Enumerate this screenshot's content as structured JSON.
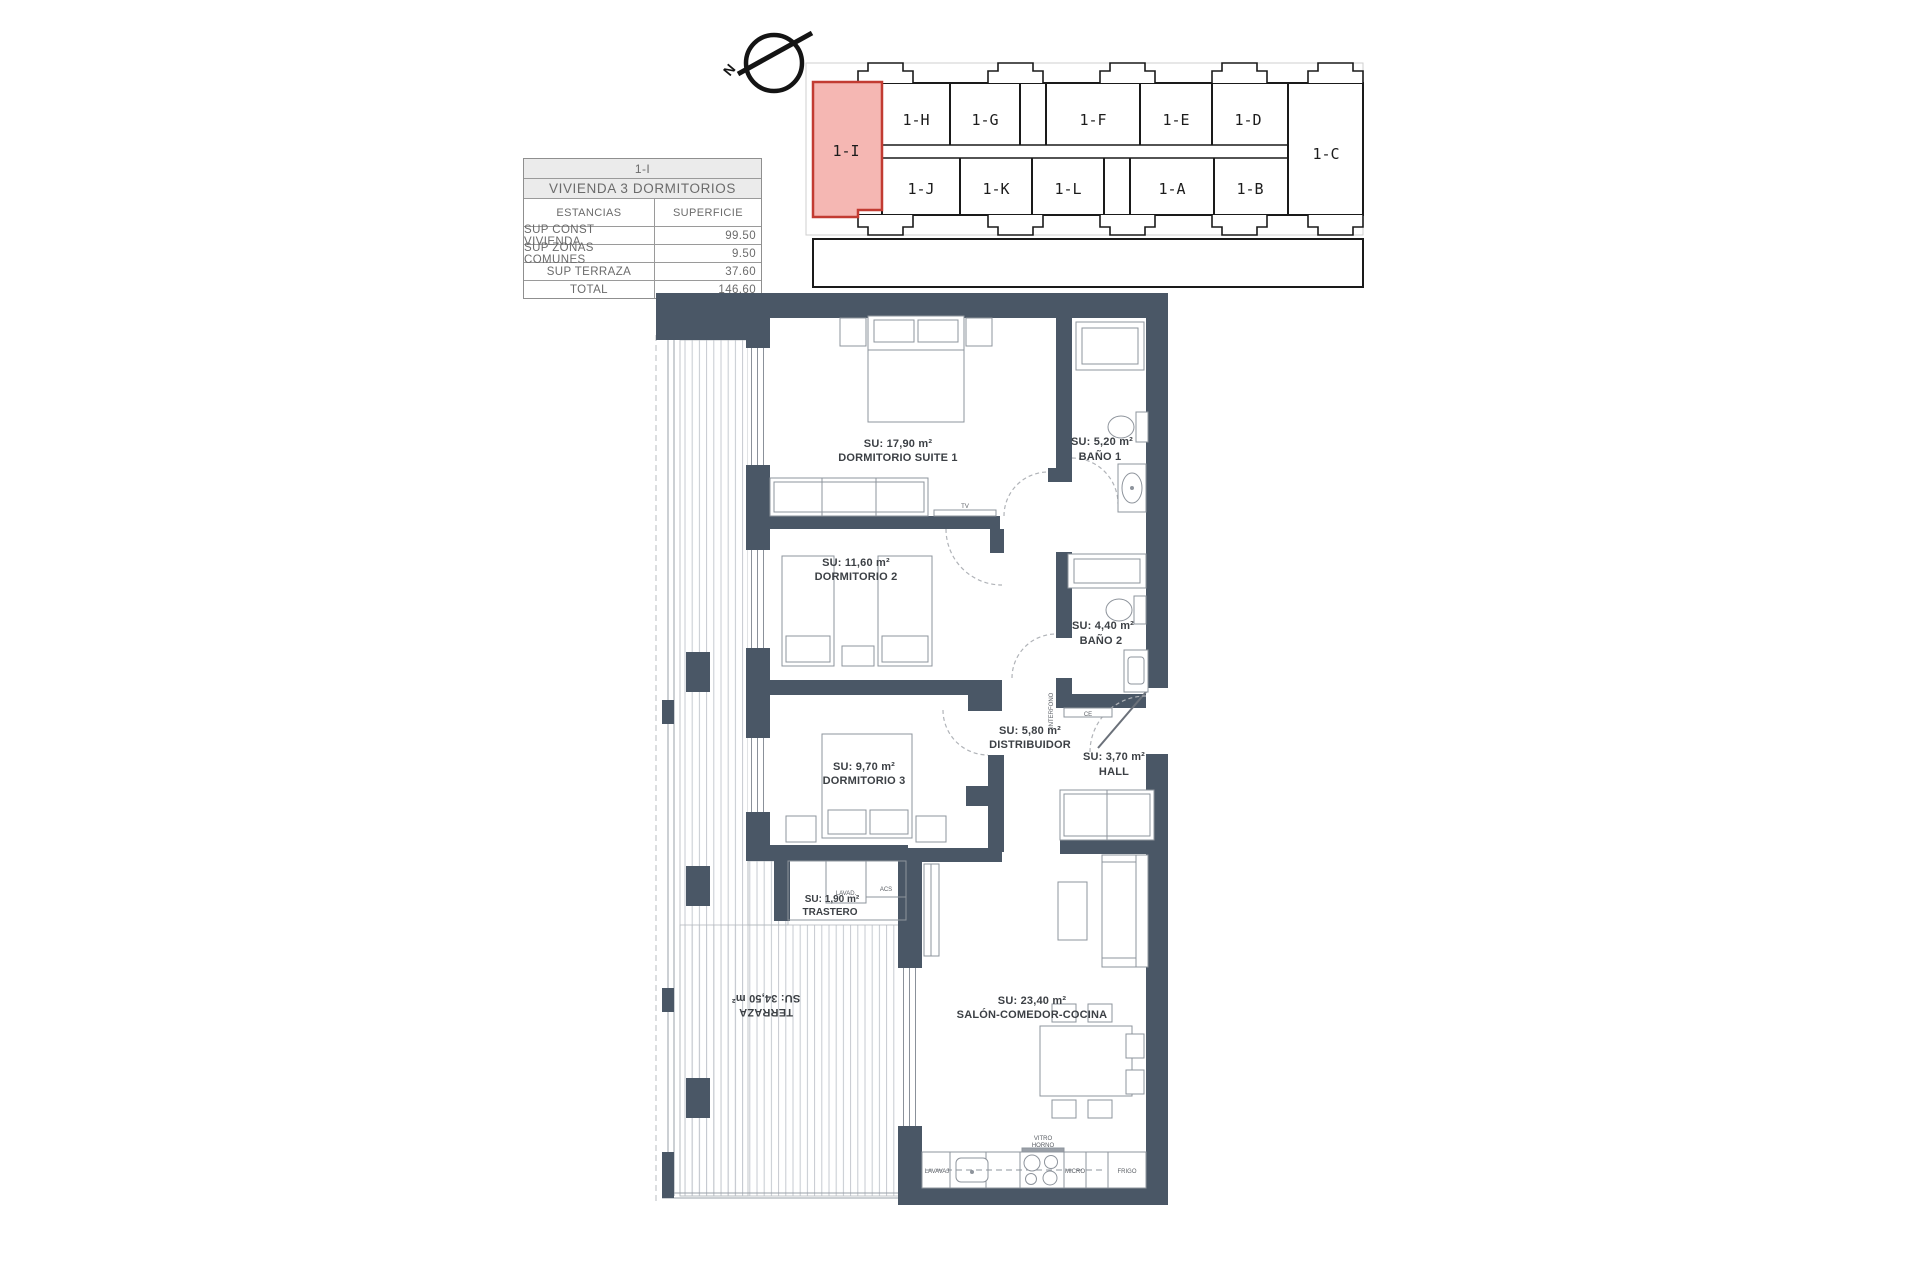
{
  "info_table": {
    "unit_code": "1-I",
    "dwelling_type": "VIVIENDA 3 DORMITORIOS",
    "header": {
      "estancias": "ESTANCIAS",
      "superficie": "SUPERFICIE"
    },
    "rows": [
      {
        "label": "SUP CONST VIVIENDA",
        "value": "99.50"
      },
      {
        "label": "SUP ZONAS COMUNES",
        "value": "9.50"
      },
      {
        "label": "SUP TERRAZA",
        "value": "37.60"
      },
      {
        "label": "TOTAL",
        "value": "146.60"
      }
    ]
  },
  "site_plan": {
    "north_letter": "N",
    "highlight": {
      "unit": "1-I",
      "fill": "#f5b7b3",
      "stroke": "#c23b32"
    },
    "units": [
      {
        "label": "1-I"
      },
      {
        "label": "1-H"
      },
      {
        "label": "1-G"
      },
      {
        "label": "1-F"
      },
      {
        "label": "1-E"
      },
      {
        "label": "1-D"
      },
      {
        "label": "1-J"
      },
      {
        "label": "1-K"
      },
      {
        "label": "1-L"
      },
      {
        "label": "1-A"
      },
      {
        "label": "1-B"
      },
      {
        "label": "1-C"
      }
    ]
  },
  "floor_plan": {
    "wall_color": "#4a5766",
    "rooms": [
      {
        "area": "SU: 17,90 m²",
        "name": "DORMITORIO SUITE 1"
      },
      {
        "area": "SU: 5,20 m²",
        "name": "BAÑO 1"
      },
      {
        "area": "SU: 11,60 m²",
        "name": "DORMITORIO 2"
      },
      {
        "area": "SU: 4,40 m²",
        "name": "BAÑO 2"
      },
      {
        "area": "SU: 5,80 m²",
        "name": "DISTRIBUIDOR"
      },
      {
        "area": "SU: 3,70 m²",
        "name": "HALL"
      },
      {
        "area": "SU: 9,70 m²",
        "name": "DORMITORIO 3"
      },
      {
        "area": "SU: 1,90 m²",
        "name": "TRASTERO"
      },
      {
        "name": "TERRAZA",
        "area": "SU: 34,50 m²"
      },
      {
        "area": "SU: 23,40 m²",
        "name": "SALÓN-COMEDOR-COCINA"
      }
    ],
    "annotations": {
      "tv": "TV",
      "lavadora": "LAVAD.",
      "acs": "ACS",
      "interfono": "INTERFONO",
      "ce": "CE",
      "lavavajillas": "LAVAVAJ",
      "vitro": "VITRO",
      "horno": "HORNO",
      "micro": "MICRO",
      "frigo": "FRIGO"
    }
  }
}
